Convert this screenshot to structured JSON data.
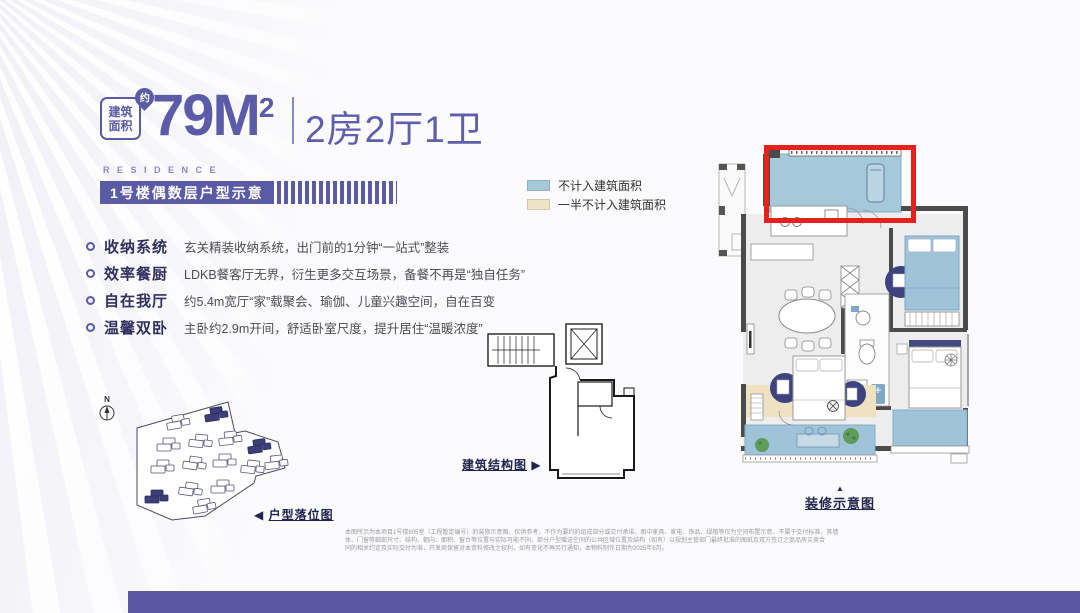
{
  "header": {
    "area_badge_l1": "建筑",
    "area_badge_l2": "面积",
    "approx": "约",
    "area_value": "79M",
    "area_sup": "2",
    "unit_layout": "2房2厅1卫",
    "residence": "RESIDENCE",
    "banner": "1号楼偶数层户型示意"
  },
  "features": [
    {
      "title": "收纳系统",
      "desc": "玄关精装收纳系统，出门前的1分钟“一站式”整装"
    },
    {
      "title": "效率餐厨",
      "desc": "LDKB餐客厅无界，衍生更多交互场景，备餐不再是“独自任务”"
    },
    {
      "title": "自在我厅",
      "desc": "约5.4m宽厅“家”载聚会、瑜伽、儿童兴趣空间，自在百变"
    },
    {
      "title": "温馨双卧",
      "desc": "主卧约2.9m开间，舒适卧室尺度，提升居住“温暖浓度”"
    }
  ],
  "legend": [
    {
      "label": "不计入建筑面积",
      "color": "#a5c8db"
    },
    {
      "label": "一半不计入建筑面积",
      "color": "#efe3c5"
    }
  ],
  "plan_labels": {
    "site": "户型落位图",
    "structure": "建筑结构图",
    "decor": "装修示意图",
    "north": "N",
    "left_arrow": "◀",
    "right_arrow": "▶",
    "up_arrow": "▲"
  },
  "disclaimer": {
    "line1": "本图所示为本项目1号楼605室（工程暂定编号）的装修示意图，仅供参考，不作为要约的组成部分或交付承诺，图中家具、家电、饰品、绿植等仅为空间布置示意，不属于交付标准，其墙",
    "line2": "体、门窗等细部尺寸、结构、朝向、面积、窗台等位置与实际可能不同，部分户型赠送空间的公共区域位置及结构（如有）以规划主管部门最终批准的图纸及双方签订之商品房买卖合",
    "line3": "同的相关约定及实际交付为准，开发商保留对本资料修改之权利，如有变化不再另行通知，本物料制作日期为2025年6月。"
  },
  "colors": {
    "accent_purple": "#5b5aa5",
    "highlight_red": "#e6211c",
    "not_counted_blue": "#a5c8db",
    "half_counted_beige": "#efe3c5",
    "dark_navy_label": "#20244e",
    "bottom_bar": "#5a57a3",
    "wall_gray": "#4b4b4b",
    "furniture_navy": "#3e4380",
    "plant_green": "#5f9b59"
  }
}
